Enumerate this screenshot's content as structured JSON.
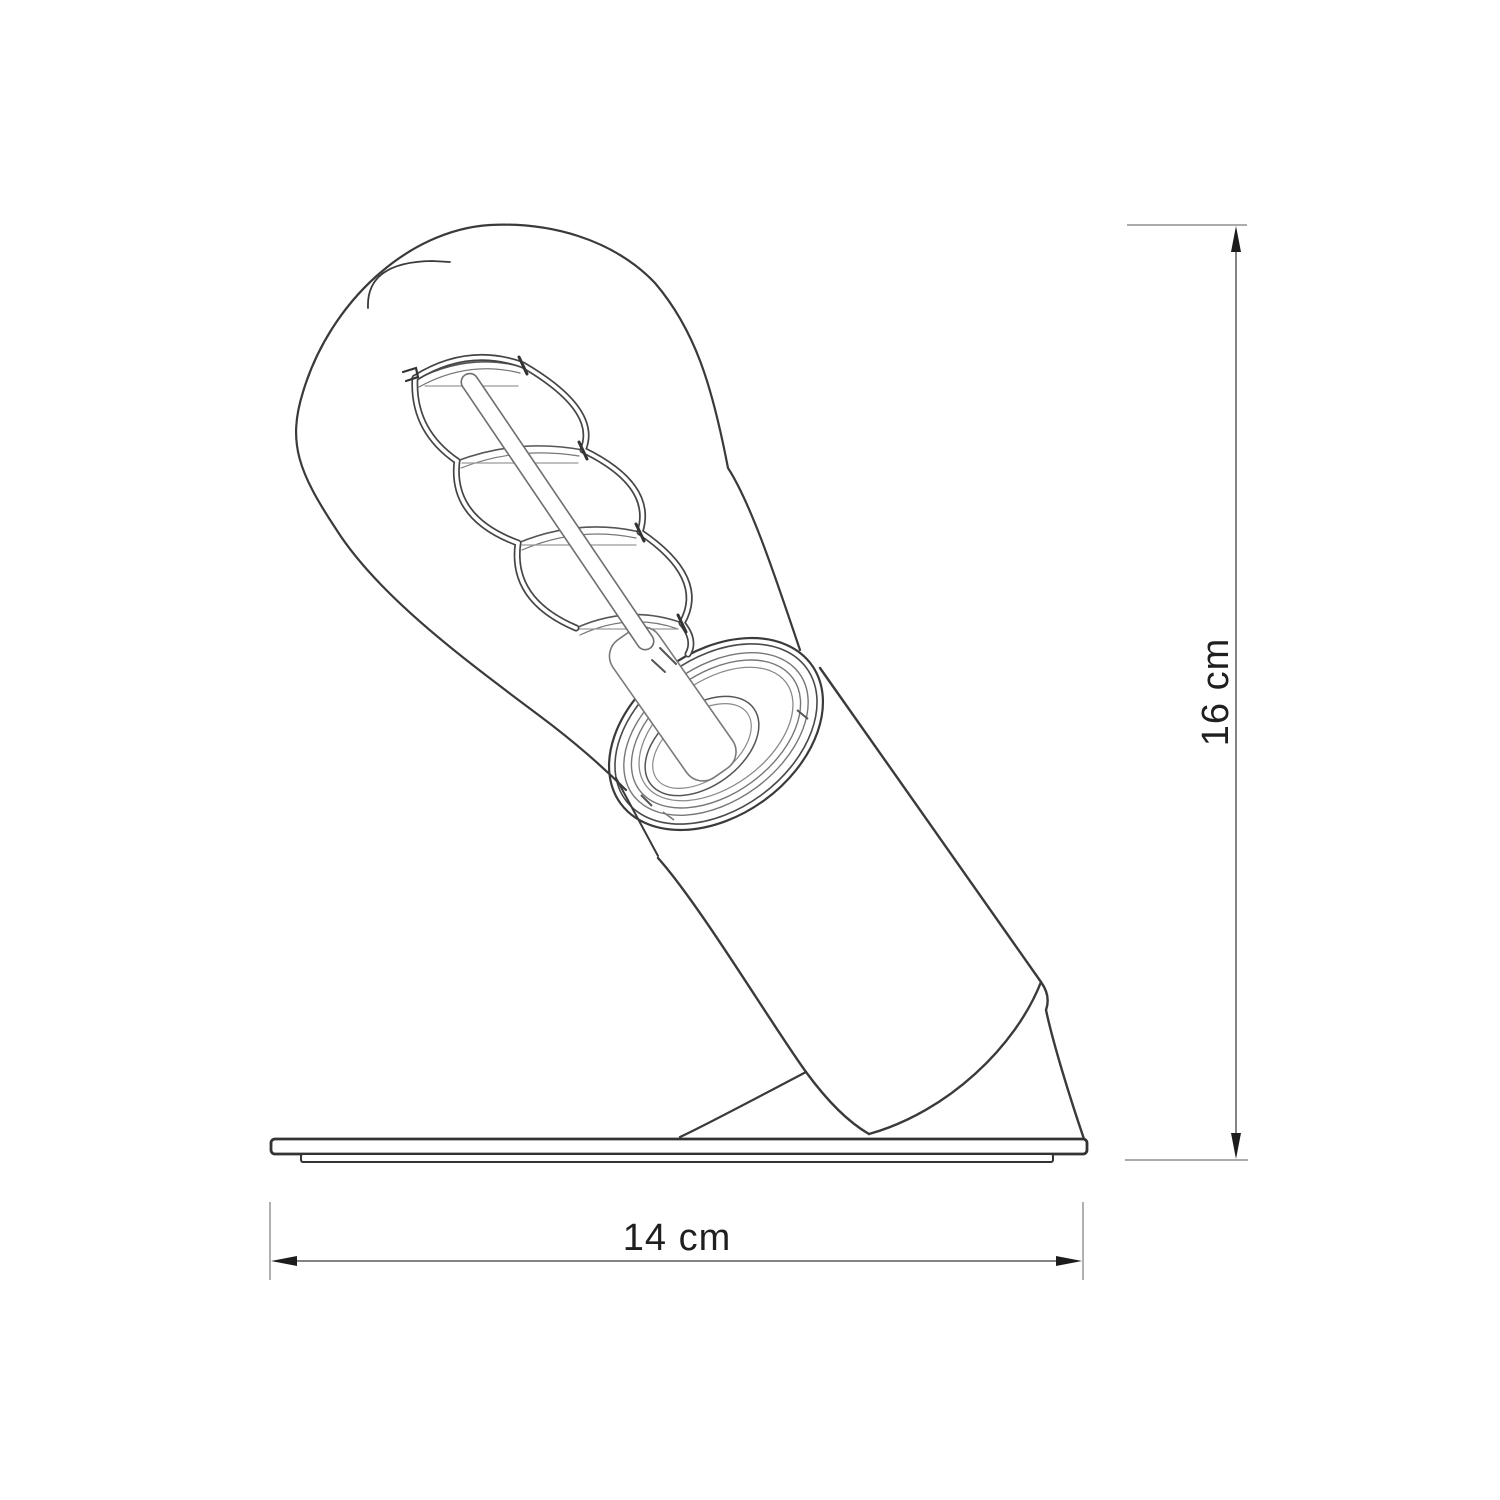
{
  "drawing": {
    "type": "technical-line-drawing",
    "subject": "tilted table lamp with spiral-filament Edison bulb, cylindrical holder and flat base plate",
    "background_color": "#ffffff",
    "outline_color": "#3a3a3a",
    "thin_line_color": "#8f8f8f",
    "dimension_line_color": "#5a5a5a",
    "arrow_color": "#1c1c1c",
    "text_color": "#1f1f1f"
  },
  "dimensions": {
    "height": {
      "value": 16,
      "unit": "cm",
      "label": "16 cm",
      "orientation": "vertical"
    },
    "width": {
      "value": 14,
      "unit": "cm",
      "label": "14 cm",
      "orientation": "horizontal"
    }
  }
}
